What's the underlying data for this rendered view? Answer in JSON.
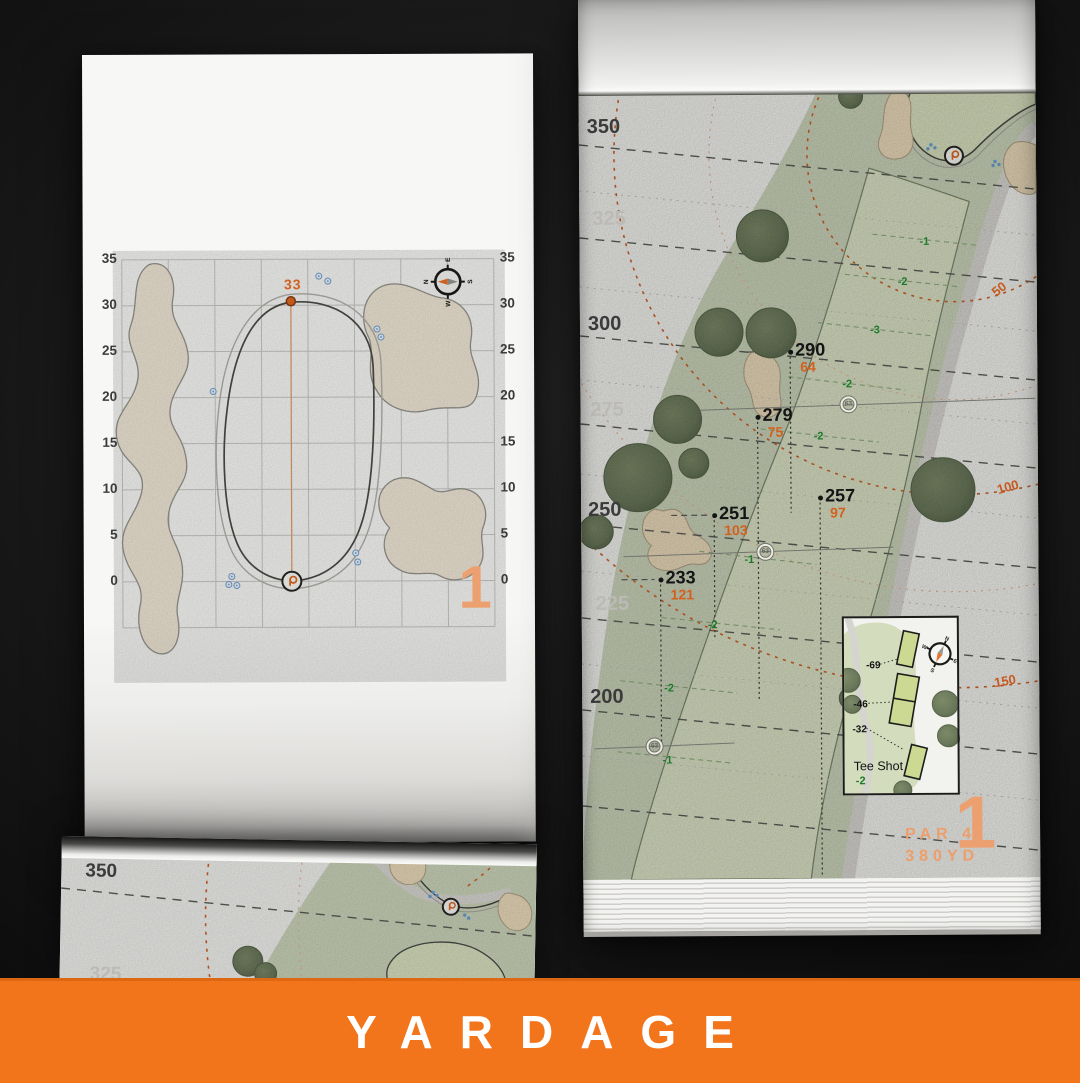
{
  "banner": {
    "label": "YARDAGE"
  },
  "colors": {
    "accent_orange": "#d2611f",
    "salmon_orange": "#eda06f",
    "banner_orange": "#f2751c",
    "slope_green": "#1d7a2d",
    "ink": "#141414",
    "muted_label": "#bcbab6",
    "dark_label": "#3b3b3b",
    "fairway_green": "#dee5c8",
    "rough_green": "#cdd6bc",
    "bunker_sand": "#ecdcbc"
  },
  "left_page": {
    "hole_number": "1",
    "pin_distance": "33",
    "axis_ticks": [
      "35",
      "30",
      "25",
      "20",
      "15",
      "10",
      "5",
      "0"
    ],
    "compass": {
      "n": "N",
      "e": "E",
      "s": "S",
      "w": "W"
    }
  },
  "right_page": {
    "hole_number": "1",
    "par_label": "PAR 4",
    "distance_label": "380YD",
    "compass": {
      "n": "N",
      "e": "E",
      "s": "S",
      "w": "W"
    },
    "distance_markers": [
      {
        "label": "350",
        "emphasis": true,
        "x": 8,
        "y": 116
      },
      {
        "label": "325",
        "emphasis": false,
        "x": 13,
        "y": 208
      },
      {
        "label": "300",
        "emphasis": true,
        "x": 8,
        "y": 313
      },
      {
        "label": "275",
        "emphasis": false,
        "x": 10,
        "y": 399
      },
      {
        "label": "250",
        "emphasis": true,
        "x": 7,
        "y": 499
      },
      {
        "label": "225",
        "emphasis": false,
        "x": 14,
        "y": 593
      },
      {
        "label": "200",
        "emphasis": true,
        "x": 8,
        "y": 686
      }
    ],
    "arc_labels": [
      {
        "label": "50",
        "x": 412,
        "y": 284,
        "rotate": -38
      },
      {
        "label": "100",
        "x": 416,
        "y": 482,
        "rotate": -15
      },
      {
        "label": "150",
        "x": 412,
        "y": 676,
        "rotate": -10
      }
    ],
    "carry_points": [
      {
        "carry": "290",
        "to_green": "64",
        "x": 210,
        "y": 353
      },
      {
        "carry": "279",
        "to_green": "75",
        "x": 177,
        "y": 418
      },
      {
        "carry": "257",
        "to_green": "97",
        "x": 239,
        "y": 499
      },
      {
        "carry": "251",
        "to_green": "103",
        "x": 133,
        "y": 516
      },
      {
        "carry": "233",
        "to_green": "121",
        "x": 79,
        "y": 580
      }
    ],
    "slope_labels": [
      {
        "label": "-1",
        "x": 340,
        "y": 238
      },
      {
        "label": "-2",
        "x": 318,
        "y": 278
      },
      {
        "label": "-3",
        "x": 290,
        "y": 326
      },
      {
        "label": "-2",
        "x": 262,
        "y": 380
      },
      {
        "label": "-2",
        "x": 233,
        "y": 432
      },
      {
        "label": "-1",
        "x": 163,
        "y": 555
      },
      {
        "label": "-2",
        "x": 126,
        "y": 620
      },
      {
        "label": "-2",
        "x": 82,
        "y": 683
      },
      {
        "label": "-1",
        "x": 80,
        "y": 755
      }
    ],
    "sprinklers": [
      {
        "label": "63",
        "x": 268,
        "y": 406
      },
      {
        "label": "63",
        "x": 184,
        "y": 553
      },
      {
        "label": "63",
        "x": 72,
        "y": 747
      }
    ],
    "tee_inset": {
      "title": "Tee Shot",
      "slope": "-2",
      "markers": [
        {
          "label": "-69",
          "x": 22,
          "y": 42
        },
        {
          "label": "-46",
          "x": 9,
          "y": 81
        },
        {
          "label": "-32",
          "x": 8,
          "y": 106
        }
      ]
    }
  },
  "preview_page": {
    "distance_markers": [
      {
        "label": "350",
        "emphasis": true,
        "x": 24,
        "y": 24
      },
      {
        "label": "325",
        "emphasis": false,
        "x": 30,
        "y": 127
      }
    ]
  }
}
